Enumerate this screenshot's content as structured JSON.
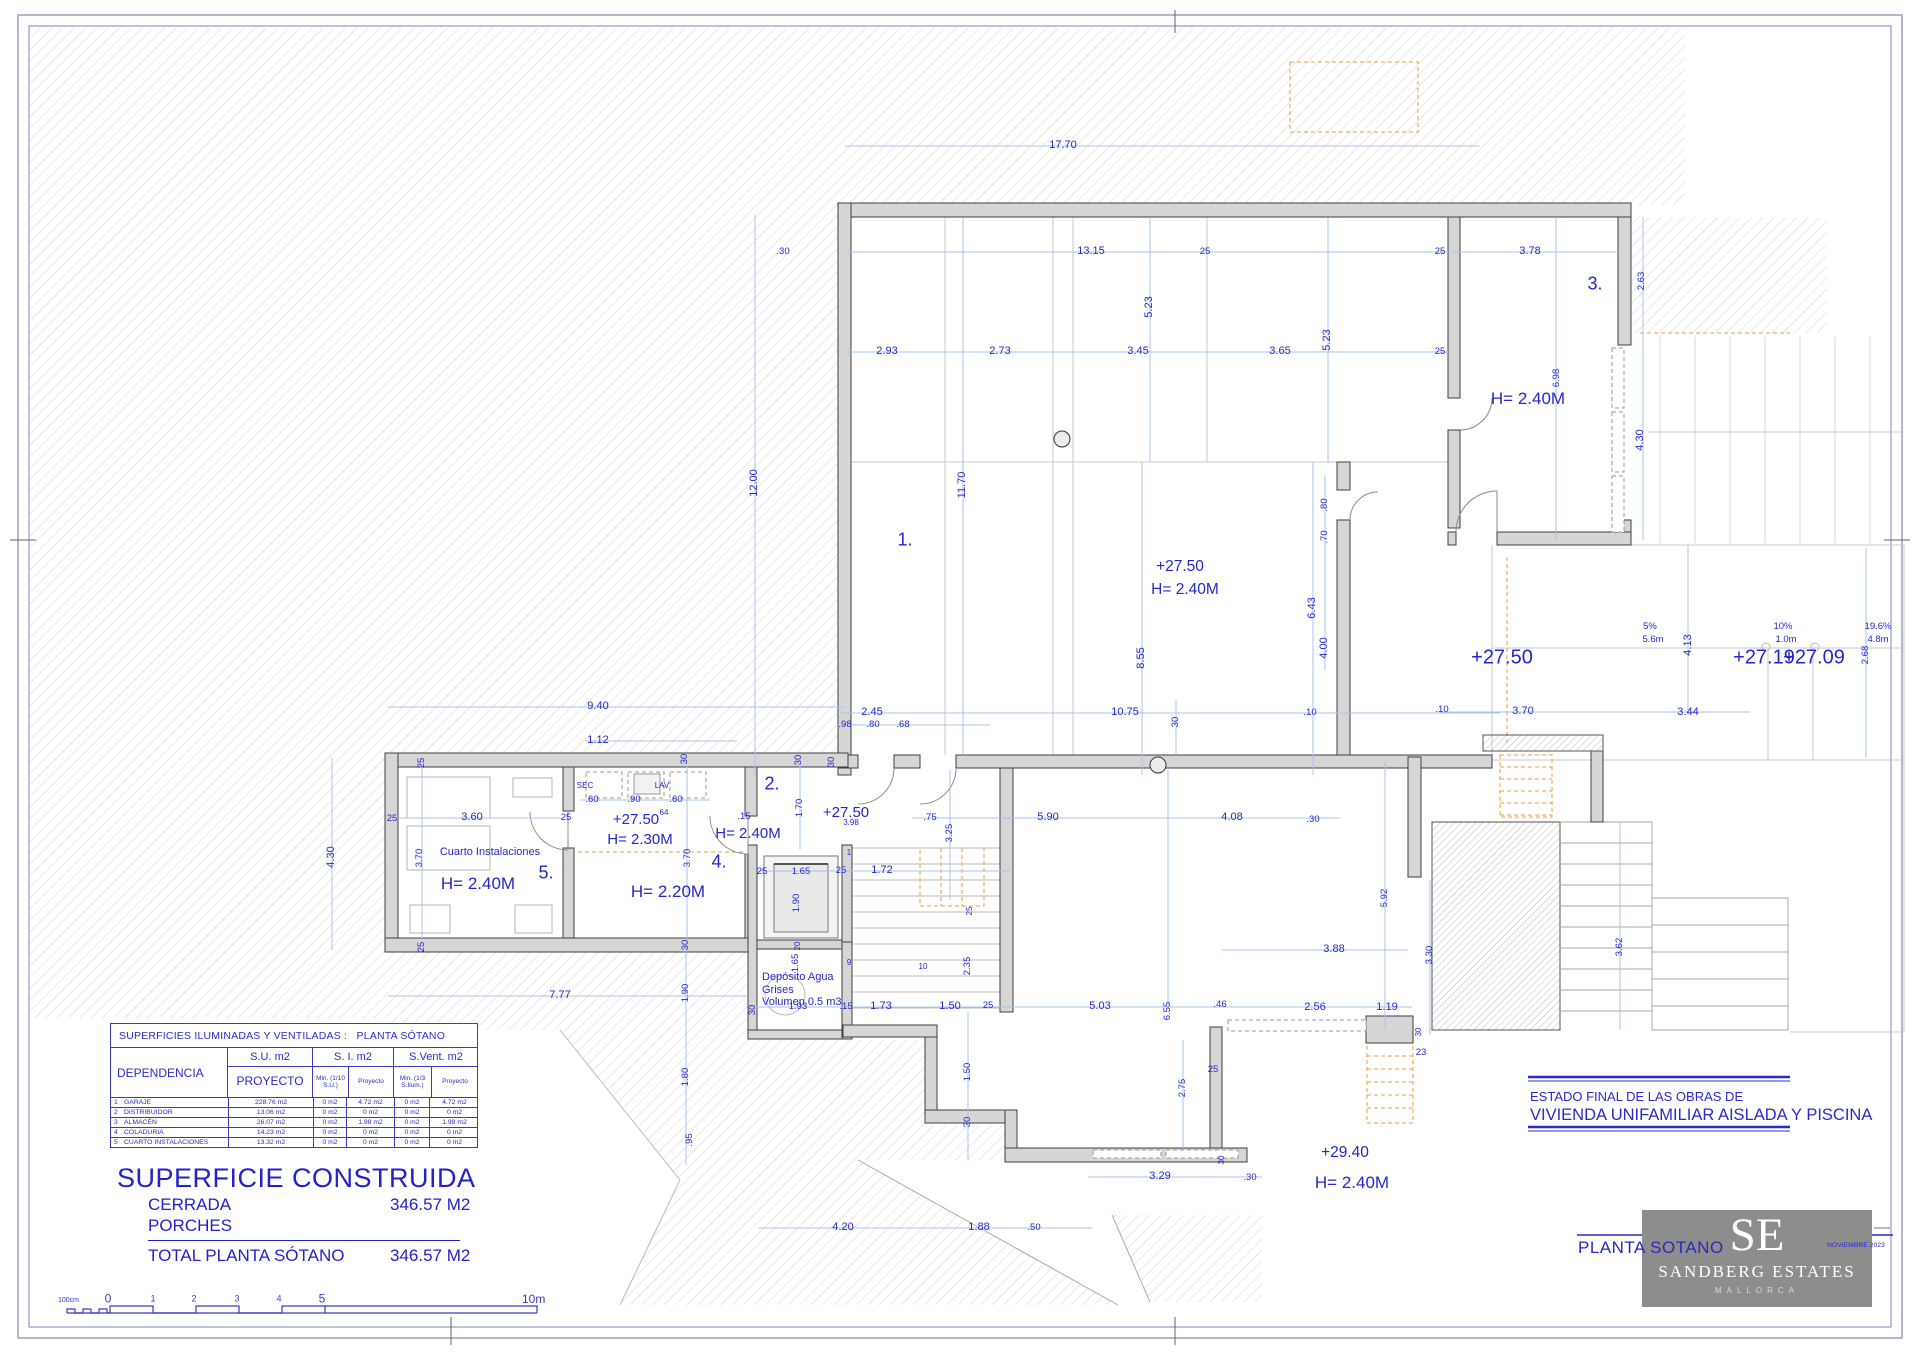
{
  "title_block": {
    "estado_line1": "ESTADO FINAL DE LAS OBRAS DE",
    "estado_line2": "VIVIENDA UNIFAMILIAR AISLADA Y PISCINA",
    "plan_name": "PLANTA SOTANO",
    "date": "NOVIEMBRE 2023",
    "logo_initials": "SE",
    "logo_name": "SANDBERG ESTATES",
    "logo_sub": "MALLORCA"
  },
  "areas_table": {
    "title": "SUPERFICIES ILUMINADAS Y VENTILADAS :   PLANTA SÓTANO",
    "dep": "DEPENDENCIA",
    "su_title": "S.U. m2",
    "su_sub": "PROYECTO",
    "si_title": "S. I. m2",
    "si_min": "Min. (1/10 S.U.)",
    "si_pro": "Proyecto",
    "sv_title": "S.Vent. m2",
    "sv_min": "Min. (1/3 S.Ilum.)",
    "sv_pro": "Proyecto",
    "rows": [
      [
        "1",
        "GARAJE",
        "228.76 m2",
        "0 m2",
        "4.72 m2",
        "0 m2",
        "4.72 m2"
      ],
      [
        "2",
        "DISTRIBUIDOR",
        "13.06 m2",
        "0 m2",
        "0 m2",
        "0 m2",
        "0 m2"
      ],
      [
        "3",
        "ALMACÉN",
        "26.07 m2",
        "0 m2",
        "1.98 m2",
        "0 m2",
        "1.98 m2"
      ],
      [
        "4",
        "COLADURIA",
        "14.23 m2",
        "0 m2",
        "0 m2",
        "0 m2",
        "0 m2"
      ],
      [
        "5",
        "CUARTO INSTALACIONES",
        "13.32 m2",
        "0 m2",
        "0 m2",
        "0 m2",
        "0 m2"
      ]
    ]
  },
  "summary": {
    "title": "SUPERFICIE CONSTRUIDA",
    "cerrada_label": "CERRADA",
    "cerrada_value": "346.57 M2",
    "porches_label": "PORCHES",
    "total_label": "TOTAL PLANTA SÓTANO",
    "total_value": "346.57 M2"
  },
  "scale_bar": {
    "unit": "100cm",
    "ticks": [
      "0",
      "1",
      "2",
      "3",
      "4",
      "5"
    ],
    "end": "10m"
  },
  "plan_labels": [
    {
      "t": "17.70",
      "x": 1063,
      "y": 146
    },
    {
      "t": "13.15",
      "x": 1091,
      "y": 252
    },
    {
      "t": ".30",
      "x": 783,
      "y": 252,
      "c": "dimsm"
    },
    {
      "t": "25",
      "x": 1205,
      "y": 252,
      "c": "dimsm"
    },
    {
      "t": "2.93",
      "x": 887,
      "y": 352
    },
    {
      "t": "2.73",
      "x": 1000,
      "y": 352
    },
    {
      "t": "3.45",
      "x": 1138,
      "y": 352
    },
    {
      "t": "3.65",
      "x": 1280,
      "y": 352
    },
    {
      "t": "5.23",
      "x": 1150,
      "y": 307,
      "r": 1
    },
    {
      "t": "5.23",
      "x": 1328,
      "y": 340,
      "r": 1
    },
    {
      "t": "12.00",
      "x": 755,
      "y": 483,
      "r": 1
    },
    {
      "t": "11.70",
      "x": 963,
      "y": 485,
      "r": 1
    },
    {
      "t": "1.",
      "x": 905,
      "y": 540,
      "c": "room"
    },
    {
      "t": "+27.50",
      "x": 1180,
      "y": 567,
      "c": "lvl"
    },
    {
      "t": "H= 2.40M",
      "x": 1185,
      "y": 590,
      "c": "lvl"
    },
    {
      "t": "8.55",
      "x": 1142,
      "y": 658,
      "r": 1
    },
    {
      "t": "6.43",
      "x": 1313,
      "y": 608,
      "r": 1
    },
    {
      "t": "4.00",
      "x": 1325,
      "y": 648,
      "r": 1
    },
    {
      "t": ".80",
      "x": 1325,
      "y": 505,
      "r": 1,
      "c": "dimsm"
    },
    {
      "t": ".70",
      "x": 1325,
      "y": 537,
      "r": 1,
      "c": "dimsm"
    },
    {
      "t": "2.45",
      "x": 872,
      "y": 713
    },
    {
      "t": "10.75",
      "x": 1125,
      "y": 713
    },
    {
      "t": ".10",
      "x": 1310,
      "y": 713,
      "c": "dimsm"
    },
    {
      "t": ".98",
      "x": 845,
      "y": 725,
      "c": "dimsm"
    },
    {
      "t": ".80",
      "x": 873,
      "y": 725,
      "c": "dimsm"
    },
    {
      "t": ".68",
      "x": 903,
      "y": 725,
      "c": "dimsm"
    },
    {
      "t": "30",
      "x": 832,
      "y": 762,
      "r": 1,
      "c": "dimsm"
    },
    {
      "t": "30",
      "x": 685,
      "y": 759,
      "r": 1,
      "c": "dimsm"
    },
    {
      "t": "30",
      "x": 799,
      "y": 760,
      "r": 1,
      "c": "dimsm"
    },
    {
      "t": "3.78",
      "x": 1530,
      "y": 252
    },
    {
      "t": "3.",
      "x": 1595,
      "y": 284,
      "c": "room"
    },
    {
      "t": "2.63",
      "x": 1642,
      "y": 281,
      "r": 1,
      "c": "dimsm"
    },
    {
      "t": "25",
      "x": 1440,
      "y": 252,
      "c": "dimsm"
    },
    {
      "t": "25",
      "x": 1440,
      "y": 352,
      "c": "dimsm"
    },
    {
      "t": "H= 2.40M",
      "x": 1528,
      "y": 399,
      "c": "h17"
    },
    {
      "t": "6.98",
      "x": 1557,
      "y": 378,
      "r": 1,
      "c": "dimsm"
    },
    {
      "t": "4.30",
      "x": 1641,
      "y": 440,
      "r": 1
    },
    {
      "t": "+27.50",
      "x": 1502,
      "y": 658,
      "c": "lvlbig"
    },
    {
      "t": "5%",
      "x": 1650,
      "y": 627,
      "c": "dimsm"
    },
    {
      "t": "5.6m",
      "x": 1653,
      "y": 640,
      "c": "dimsm"
    },
    {
      "t": "4.13",
      "x": 1689,
      "y": 645,
      "r": 1
    },
    {
      "t": "10%",
      "x": 1783,
      "y": 627,
      "c": "dimsm"
    },
    {
      "t": "1.0m",
      "x": 1786,
      "y": 640,
      "c": "dimsm"
    },
    {
      "t": "19.6%",
      "x": 1878,
      "y": 627,
      "c": "dimsm"
    },
    {
      "t": "4.8m",
      "x": 1878,
      "y": 640,
      "c": "dimsm"
    },
    {
      "t": "+27.19",
      "x": 1764,
      "y": 658,
      "c": "lvlbig"
    },
    {
      "t": "+27.09",
      "x": 1814,
      "y": 658,
      "c": "lvlbig"
    },
    {
      "t": "3.70",
      "x": 1523,
      "y": 712
    },
    {
      "t": "3.44",
      "x": 1688,
      "y": 713
    },
    {
      "t": ".10",
      "x": 1442,
      "y": 710,
      "c": "dimsm"
    },
    {
      "t": "2.68",
      "x": 1866,
      "y": 655,
      "r": 1,
      "c": "dimsm"
    },
    {
      "t": "9.40",
      "x": 598,
      "y": 707
    },
    {
      "t": "1.12",
      "x": 598,
      "y": 741
    },
    {
      "t": "25",
      "x": 422,
      "y": 763,
      "r": 1,
      "c": "dimsm"
    },
    {
      "t": "25",
      "x": 392,
      "y": 819,
      "c": "dimsm"
    },
    {
      "t": "25",
      "x": 422,
      "y": 947,
      "r": 1,
      "c": "dimsm"
    },
    {
      "t": "4.30",
      "x": 332,
      "y": 857,
      "r": 1
    },
    {
      "t": "3.60",
      "x": 472,
      "y": 818
    },
    {
      "t": "3.70",
      "x": 420,
      "y": 858,
      "r": 1,
      "c": "dimsm"
    },
    {
      "t": "Cuarto Instalaciones",
      "x": 490,
      "y": 853,
      "c": "note"
    },
    {
      "t": "H= 2.40M",
      "x": 478,
      "y": 884,
      "c": "h17"
    },
    {
      "t": "5.",
      "x": 546,
      "y": 873,
      "c": "room"
    },
    {
      "t": "SEC",
      "x": 585,
      "y": 786,
      "c": "tiny"
    },
    {
      "t": "LAV",
      "x": 662,
      "y": 786,
      "c": "tiny"
    },
    {
      "t": ".60",
      "x": 592,
      "y": 800,
      "c": "dimsm"
    },
    {
      "t": ".90",
      "x": 634,
      "y": 800,
      "c": "dimsm"
    },
    {
      "t": ".60",
      "x": 676,
      "y": 800,
      "c": "dimsm"
    },
    {
      "t": "+27.50",
      "x": 636,
      "y": 820,
      "c": "h15"
    },
    {
      "t": "64",
      "x": 664,
      "y": 813,
      "c": "tiny"
    },
    {
      "t": "H= 2.30M",
      "x": 640,
      "y": 840,
      "c": "h15"
    },
    {
      "t": "25",
      "x": 566,
      "y": 818,
      "c": "dimsm"
    },
    {
      "t": ".15",
      "x": 744,
      "y": 817,
      "c": "dimsm"
    },
    {
      "t": "H= 2.40M",
      "x": 748,
      "y": 834,
      "c": "h15"
    },
    {
      "t": "4.",
      "x": 719,
      "y": 862,
      "c": "room"
    },
    {
      "t": "H= 2.20M",
      "x": 668,
      "y": 892,
      "c": "h17"
    },
    {
      "t": "3.70",
      "x": 688,
      "y": 858,
      "r": 1,
      "c": "dimsm"
    },
    {
      "t": "2.",
      "x": 772,
      "y": 784,
      "c": "room"
    },
    {
      "t": "1.70",
      "x": 800,
      "y": 808,
      "r": 1,
      "c": "dimsm"
    },
    {
      "t": "+27.50",
      "x": 846,
      "y": 813,
      "c": "h15"
    },
    {
      "t": "3.98",
      "x": 851,
      "y": 823,
      "c": "tiny"
    },
    {
      "t": "7.77",
      "x": 560,
      "y": 996
    },
    {
      "t": "25",
      "x": 762,
      "y": 872,
      "c": "dimsm"
    },
    {
      "t": "1.65",
      "x": 801,
      "y": 872,
      "c": "dimsm"
    },
    {
      "t": "25",
      "x": 841,
      "y": 871,
      "c": "dimsm"
    },
    {
      "t": "1.90",
      "x": 797,
      "y": 903,
      "r": 1,
      "c": "dimsm"
    },
    {
      "t": "20",
      "x": 798,
      "y": 946,
      "r": 1,
      "c": "tiny"
    },
    {
      "t": "1.65",
      "x": 796,
      "y": 963,
      "r": 1,
      "c": "dimsm"
    },
    {
      "t": "Depósito Agua\nGrises\nVolumen 0.5 m3",
      "x": 762,
      "y": 990,
      "c": "notel"
    },
    {
      "t": "1.93",
      "x": 798,
      "y": 1007,
      "c": "dimsm"
    },
    {
      "t": "1",
      "x": 849,
      "y": 853,
      "c": "tiny"
    },
    {
      "t": "9",
      "x": 849,
      "y": 963,
      "c": "tiny"
    },
    {
      "t": "10",
      "x": 923,
      "y": 967,
      "c": "tiny"
    },
    {
      "t": "1.72",
      "x": 882,
      "y": 871
    },
    {
      "t": "2.35",
      "x": 968,
      "y": 966,
      "r": 1,
      "c": "dimsm"
    },
    {
      "t": "25",
      "x": 970,
      "y": 911,
      "r": 1,
      "c": "tiny"
    },
    {
      "t": "30",
      "x": 753,
      "y": 1010,
      "r": 1,
      "c": "dimsm"
    },
    {
      "t": ".15",
      "x": 846,
      "y": 1007,
      "c": "dimsm"
    },
    {
      "t": "1.73",
      "x": 881,
      "y": 1007
    },
    {
      "t": "1.50",
      "x": 950,
      "y": 1007
    },
    {
      "t": "25",
      "x": 988,
      "y": 1006,
      "c": "dimsm"
    },
    {
      "t": "5.03",
      "x": 1100,
      "y": 1007
    },
    {
      "t": "6.55",
      "x": 1168,
      "y": 1011,
      "r": 1,
      "c": "dimsm"
    },
    {
      "t": ".46",
      "x": 1220,
      "y": 1005,
      "c": "dimsm"
    },
    {
      "t": "2.56",
      "x": 1315,
      "y": 1008
    },
    {
      "t": "1.19",
      "x": 1387,
      "y": 1008
    },
    {
      "t": "30",
      "x": 686,
      "y": 945,
      "r": 1,
      "c": "dimsm"
    },
    {
      "t": "1.90",
      "x": 686,
      "y": 993,
      "r": 1,
      "c": "dimsm"
    },
    {
      "t": "1.80",
      "x": 686,
      "y": 1077,
      "r": 1,
      "c": "dimsm"
    },
    {
      "t": ".95",
      "x": 690,
      "y": 1140,
      "r": 1,
      "c": "dimsm"
    },
    {
      "t": "1.50",
      "x": 968,
      "y": 1072,
      "r": 1,
      "c": "dimsm"
    },
    {
      "t": "30",
      "x": 968,
      "y": 1122,
      "r": 1,
      "c": "dimsm"
    },
    {
      "t": "2.75",
      "x": 1183,
      "y": 1088,
      "r": 1,
      "c": "dimsm"
    },
    {
      "t": "25",
      "x": 1213,
      "y": 1070,
      "c": "dimsm"
    },
    {
      "t": "3.29",
      "x": 1160,
      "y": 1177
    },
    {
      "t": ".30",
      "x": 1250,
      "y": 1178,
      "c": "dimsm"
    },
    {
      "t": "30",
      "x": 1222,
      "y": 1160,
      "r": 1,
      "c": "tiny"
    },
    {
      "t": "4.20",
      "x": 843,
      "y": 1228
    },
    {
      "t": "1.88",
      "x": 979,
      "y": 1228
    },
    {
      "t": ".50",
      "x": 1034,
      "y": 1228,
      "c": "dimsm"
    },
    {
      "t": "+29.40",
      "x": 1345,
      "y": 1153,
      "c": "lvl"
    },
    {
      "t": "H= 2.40M",
      "x": 1352,
      "y": 1183,
      "c": "h17"
    },
    {
      "t": "3.88",
      "x": 1334,
      "y": 950
    },
    {
      "t": "5.92",
      "x": 1385,
      "y": 898,
      "r": 1,
      "c": "dimsm"
    },
    {
      "t": "3.30",
      "x": 1430,
      "y": 955,
      "r": 1,
      "c": "dimsm"
    },
    {
      "t": "30",
      "x": 1419,
      "y": 1032,
      "r": 1,
      "c": "tiny"
    },
    {
      "t": "23",
      "x": 1421,
      "y": 1053,
      "c": "dimsm"
    },
    {
      "t": "3.62",
      "x": 1620,
      "y": 947,
      "r": 1,
      "c": "dimsm"
    },
    {
      "t": "5.90",
      "x": 1048,
      "y": 818
    },
    {
      "t": "4.08",
      "x": 1232,
      "y": 818
    },
    {
      "t": ".75",
      "x": 930,
      "y": 818,
      "c": "dimsm"
    },
    {
      "t": "3.25",
      "x": 950,
      "y": 833,
      "r": 1,
      "c": "dimsm"
    },
    {
      "t": ".30",
      "x": 1313,
      "y": 820,
      "c": "dimsm"
    },
    {
      "t": "30",
      "x": 1176,
      "y": 722,
      "r": 1,
      "c": "dimsm"
    }
  ]
}
